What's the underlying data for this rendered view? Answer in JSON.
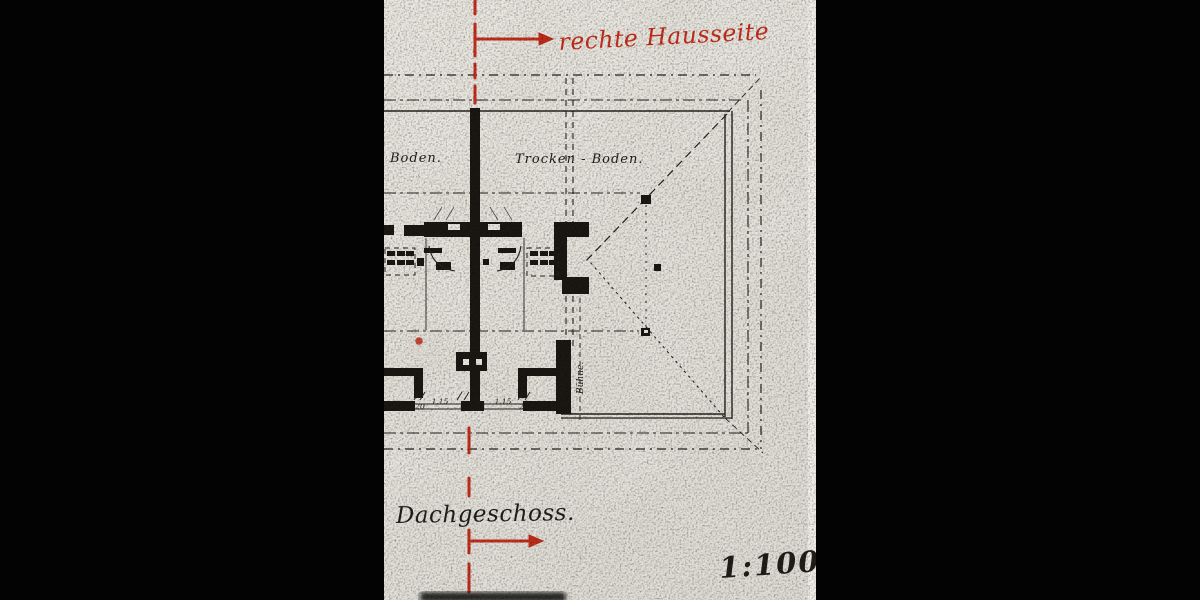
{
  "scan": {
    "annotations": {
      "side_note": "rechte Hausseite",
      "floor_title": "Dachgeschoss.",
      "scale": "1:100"
    },
    "plan": {
      "room_left": "Boden.",
      "room_right": "Trocken - Boden.",
      "loft_label": "Bühne.",
      "dims": [
        {
          "label": "20"
        },
        {
          "label": "1,15"
        },
        {
          "label": "1,15"
        },
        {
          "label": "20"
        }
      ]
    },
    "icons": {
      "top_arrow": "arrow-right-icon",
      "bottom_arrow": "arrow-right-icon",
      "guide": "red-dashed-section-line"
    },
    "colors": {
      "annotation_red": "#c42e1c",
      "paper": "#e8e6df",
      "ink": "#211e19",
      "letterbox": "#030303"
    }
  }
}
